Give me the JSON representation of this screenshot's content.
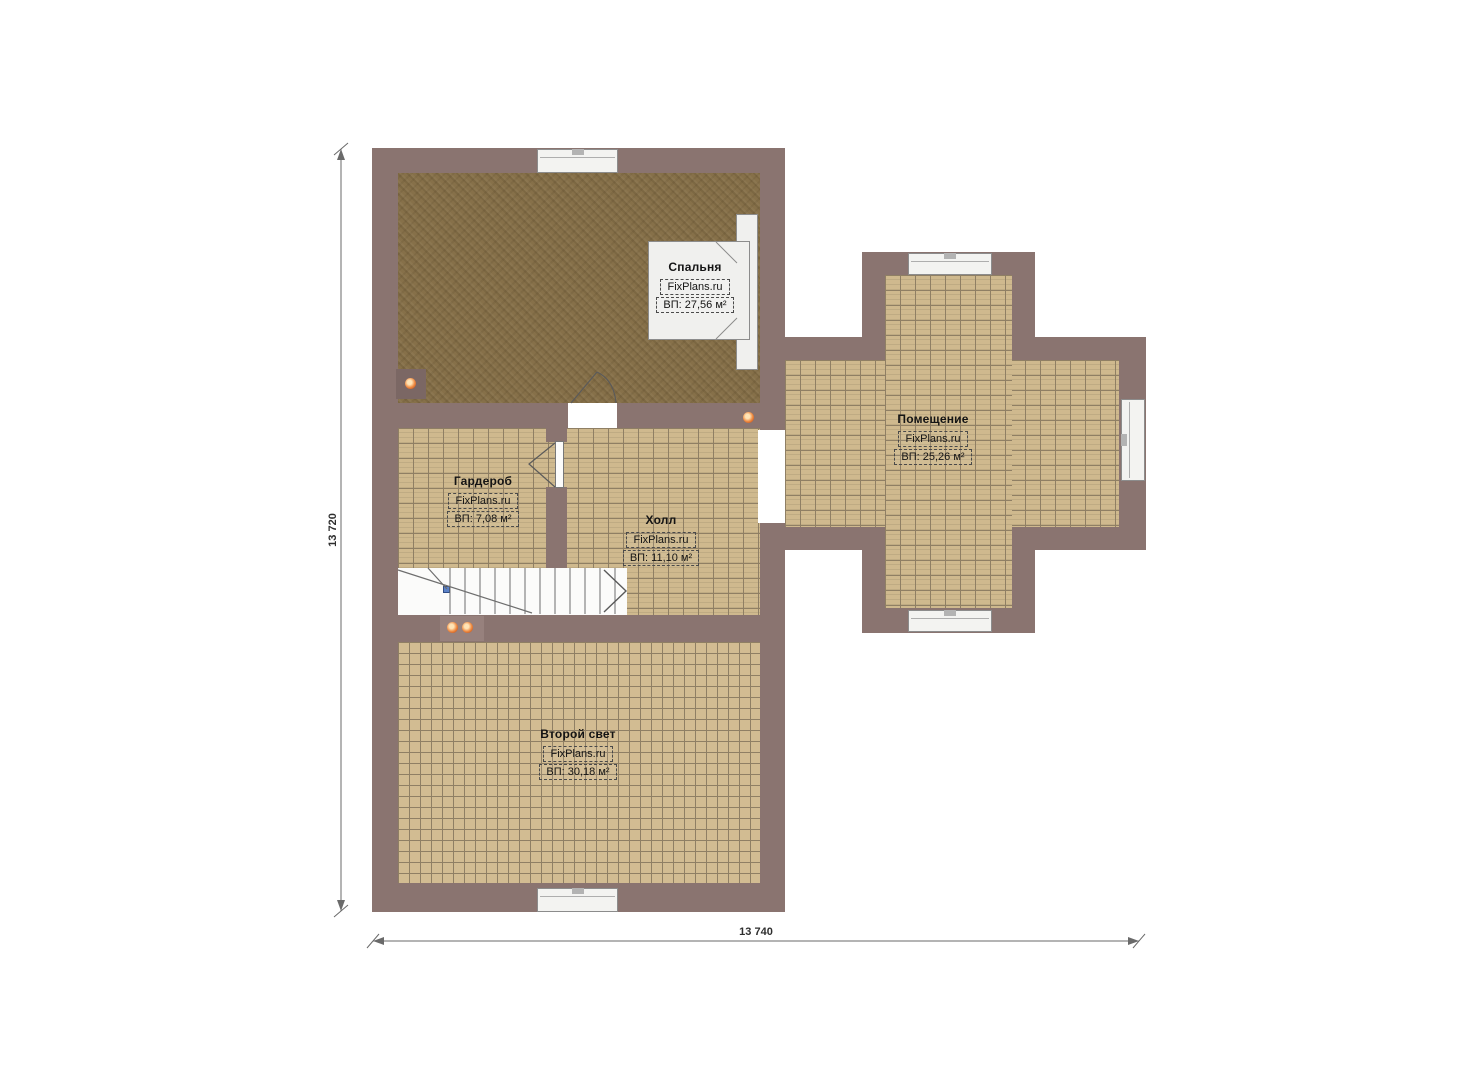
{
  "plan": {
    "type": "floor-plan",
    "brand": "FixPlans.ru",
    "rooms": [
      {
        "name": "Спальня",
        "brand": "FixPlans.ru",
        "area": "ВП: 27,56 м²"
      },
      {
        "name": "Помещение",
        "brand": "FixPlans.ru",
        "area": "ВП: 25,26 м²"
      },
      {
        "name": "Гардероб",
        "brand": "FixPlans.ru",
        "area": "ВП: 7,08 м²"
      },
      {
        "name": "Холл",
        "brand": "FixPlans.ru",
        "area": "ВП: 11,10 м²"
      },
      {
        "name": "Второй свет",
        "brand": "FixPlans.ru",
        "area": "ВП: 30,18 м²"
      }
    ],
    "dimensions": {
      "left": "13 720",
      "bottom": "13 740"
    },
    "colors": {
      "wall": "#8a7470",
      "carpet": "#867049",
      "tile": "#cfb98e",
      "tile_grid": "#8f7f64",
      "window": "#f3f3f1",
      "light_dot": "#ef8c43",
      "stair_marker": "#5b82c8"
    }
  }
}
